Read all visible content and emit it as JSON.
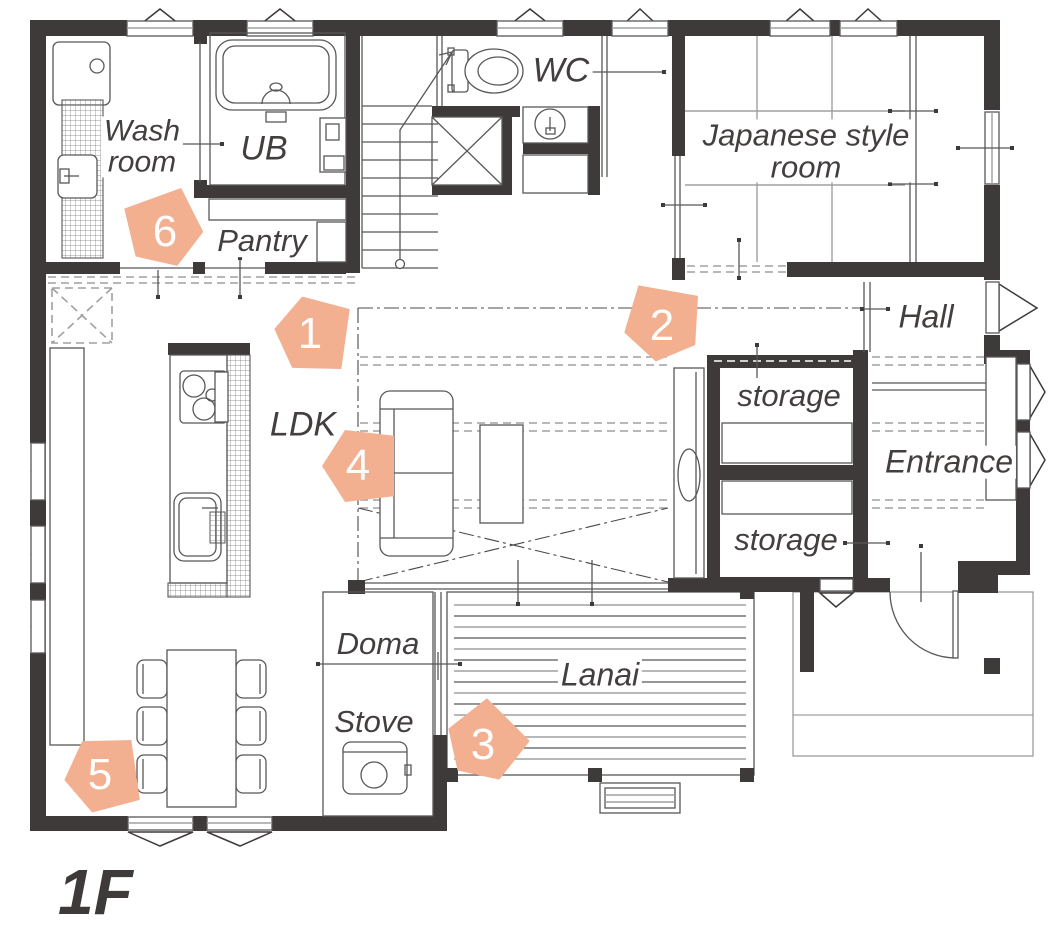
{
  "floor_label": "1F",
  "colors": {
    "wall": "#3e3a39",
    "marker": "#f2b091",
    "line": "#595757",
    "grid_line": "#9fa0a0",
    "text": "#433f3e",
    "marker_number": "#ffffff"
  },
  "rooms": {
    "wash_room": {
      "line1": "Wash",
      "line2": "room"
    },
    "ub": "UB",
    "pantry": "Pantry",
    "wc": "WC",
    "japanese_room": {
      "line1": "Japanese style",
      "line2": "room"
    },
    "hall": "Hall",
    "storage_upper": "storage",
    "storage_lower": "storage",
    "entrance": "Entrance",
    "ldk": "LDK",
    "doma": "Doma",
    "stove": "Stove",
    "lanai": "Lanai"
  },
  "markers": {
    "m1": "1",
    "m2": "2",
    "m3": "3",
    "m4": "4",
    "m5": "5",
    "m6": "6"
  },
  "fixtures": [
    "bathtub",
    "washing-machine",
    "laundry-counter",
    "utility-sink",
    "toilet",
    "wash-basin",
    "staircase",
    "void-shaft",
    "kitchen-island",
    "cooktop",
    "kitchen-sink",
    "sliding-door",
    "sofa",
    "coffee-table",
    "dining-table",
    "dining-chairs",
    "wood-stove",
    "deck",
    "deck-step",
    "entrance-door",
    "shoe-cabinet",
    "porch",
    "awning-window",
    "casement-window",
    "tatami-mats"
  ]
}
